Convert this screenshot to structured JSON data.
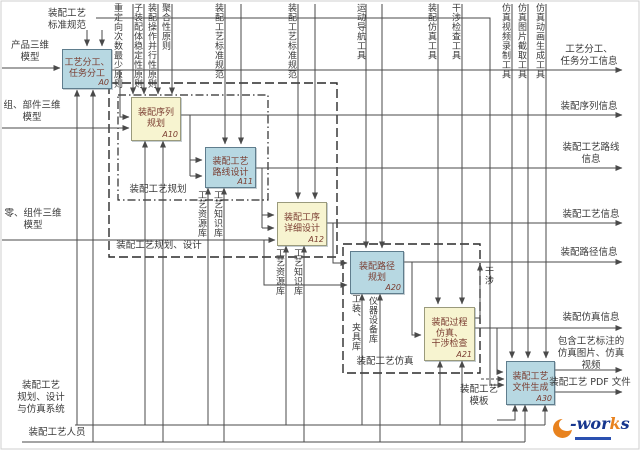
{
  "colors": {
    "box_blue": "#b7d8e2",
    "box_yellow": "#f7f4d0",
    "box_border_blue": "#5f7d8d",
    "box_text": "#7a3c30",
    "line": "#4a4a4a",
    "label_text": "#3a3a3a",
    "logo_navy": "#16368e",
    "logo_orange": "#e8821e"
  },
  "boxes": {
    "a0": {
      "label": "工艺分工、\n任务分工",
      "code": "A0"
    },
    "a10": {
      "label": "装配序列\n规划",
      "code": "A10"
    },
    "a11": {
      "label": "装配工艺\n路线设计",
      "code": "A11"
    },
    "a12": {
      "label": "装配工序\n详细设计",
      "code": "A12"
    },
    "a20": {
      "label": "装配路径\n规划",
      "code": "A20"
    },
    "a21": {
      "label": "装配过程\n仿真、\n干涉检查",
      "code": "A21"
    },
    "a30": {
      "label": "装配工艺\n文件生成",
      "code": "A30"
    }
  },
  "inputs": {
    "product_model": "产品三维\n模型",
    "component_model": "组、部件三维\n模型",
    "part_model": "零、组件三维\n模型"
  },
  "controls": {
    "standard_top": "装配工艺\n标准规范",
    "principles": [
      "重定向次数最少原则",
      "子装配体稳定性原则",
      "装配操作并行性原则",
      "聚合性原则"
    ],
    "standard_a11": "装配工艺标准规范",
    "standard_a12": "装配工艺标准规范",
    "tools": [
      "运动导航工具",
      "装配仿真工具",
      "干涉检查工具",
      "仿真视频录制工具",
      "仿真图片截取工具",
      "仿真动画生成工具"
    ]
  },
  "outputs": [
    "工艺分工、\n任务分工信息",
    "装配序列信息",
    "装配工艺路线\n信息",
    "装配工艺信息",
    "装配路径信息",
    "装配仿真信息",
    "包含工艺标注的\n仿真图片、仿真\n视频",
    "装配工艺 PDF 文件"
  ],
  "mechanisms": {
    "system": "装配工艺\n规划、设计\n与仿真系统",
    "personnel": "装配工艺人员",
    "template": "装配工艺\n模板"
  },
  "resources": [
    "工艺资源库",
    "工艺知识库",
    "工艺资源库",
    "工艺知识库",
    "工装、夹具库",
    "仪器设备库"
  ],
  "groups": {
    "planning": "装配工艺规划",
    "planning_design": "装配工艺规划、设计",
    "simulation": "装配工艺仿真"
  },
  "feedback": {
    "interference": "干涉"
  },
  "logo": {
    "dash": "-",
    "mid": "wor",
    "accent": "k",
    "end": "s"
  }
}
